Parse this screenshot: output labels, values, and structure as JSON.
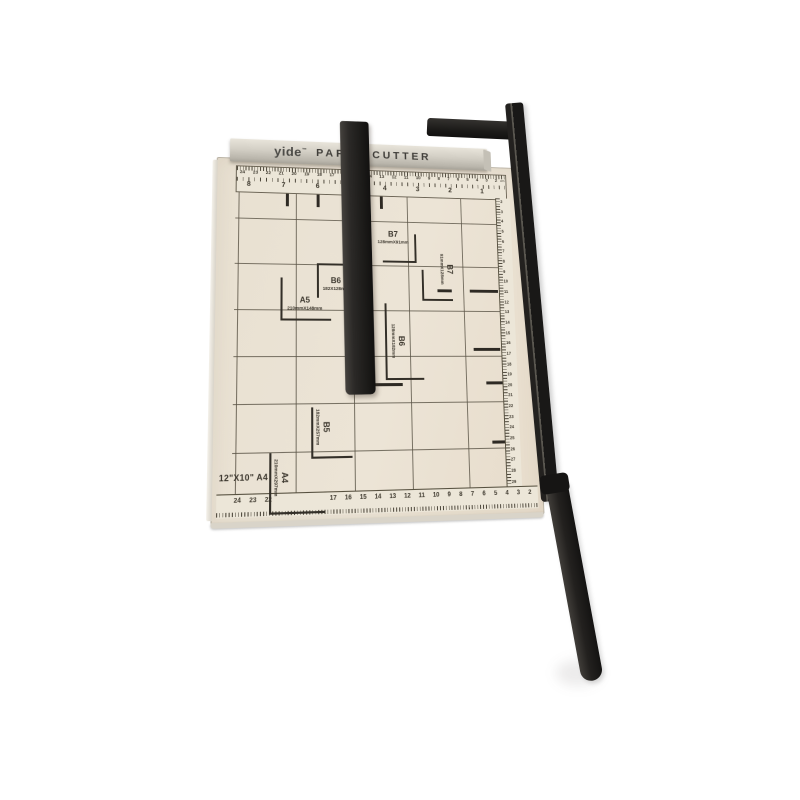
{
  "product": {
    "brand": "yide",
    "brand_mark": "™",
    "title": "PAPER CUTTER",
    "size_note": "12\"X10\" A4"
  },
  "colors": {
    "background": "#ffffff",
    "board": "#eae2d3",
    "metal_strip": "#cbc7bc",
    "hardware_black": "#1d1b19",
    "markings": "#3b362d"
  },
  "size_marks": {
    "b7_h": {
      "label": "B7",
      "dims": "128mmX91mm"
    },
    "b7_v": {
      "label": "B7",
      "dims": "91mmX128mm"
    },
    "b6_h": {
      "label": "B6",
      "dims": "182X128mm"
    },
    "a5": {
      "label": "A5",
      "dims": "210mmX148mm"
    },
    "b6_v": {
      "label": "B6",
      "dims": "128mmX182mm"
    },
    "b5_v": {
      "label": "B5",
      "dims": "182mmX257mm"
    },
    "a4_v": {
      "label": "A4",
      "dims": "210mmX297mm"
    }
  },
  "rulers": {
    "unit": "cm",
    "top_cm": [
      "24",
      "23",
      "22",
      "21",
      "20",
      "19",
      "18",
      "17",
      "16",
      "15",
      "14",
      "13",
      "12",
      "11",
      "10",
      "9",
      "8",
      "7",
      "6",
      "5",
      "4",
      "3",
      "2"
    ],
    "top_inch": [
      "8",
      "7",
      "6",
      "5",
      "4",
      "3",
      "2",
      "1"
    ],
    "bottom_cm": [
      "24",
      "23",
      "22",
      "",
      "",
      "",
      "",
      "17",
      "16",
      "15",
      "14",
      "13",
      "12",
      "11",
      "10",
      "9",
      "8",
      "7",
      "6",
      "5",
      "4",
      "3",
      "2"
    ],
    "right_cm": [
      "2",
      "3",
      "4",
      "5",
      "6",
      "7",
      "8",
      "9",
      "10",
      "11",
      "12",
      "13",
      "14",
      "15",
      "16",
      "17",
      "18",
      "19",
      "20",
      "21",
      "22",
      "23",
      "24",
      "25",
      "26",
      "27",
      "28",
      "29"
    ]
  }
}
